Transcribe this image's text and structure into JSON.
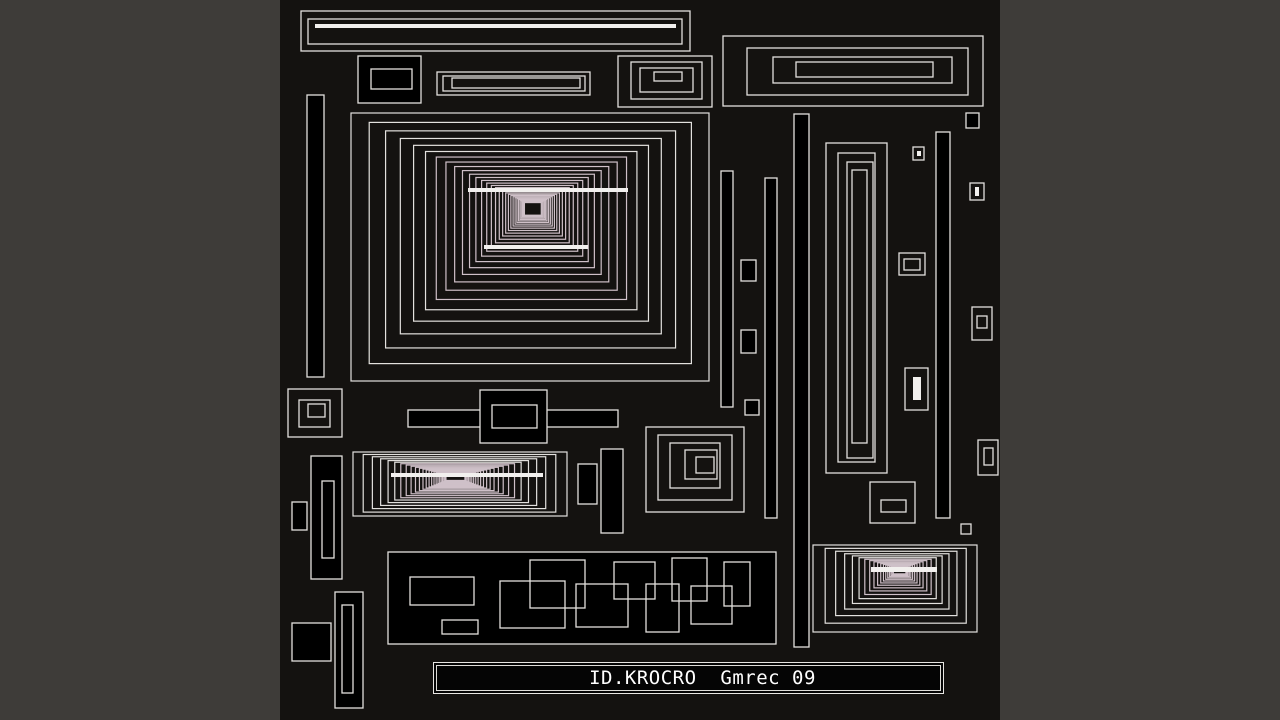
{
  "title_bar": {
    "text": "ID.KROCRO  Gmrec 09"
  },
  "colors": {
    "matte": "#3e3c39",
    "canvas_bg": "#141210",
    "shape_fill": "#000000",
    "stroke": "#e3e1de",
    "stroke_soft": "#cfc0c8",
    "accent_white": "#f2f0ee",
    "text": "#ffffff"
  },
  "artwork": {
    "shapes": [
      {
        "t": "o",
        "x": 301,
        "y": 11,
        "w": 389,
        "h": 40
      },
      {
        "t": "o",
        "x": 308,
        "y": 19,
        "w": 374,
        "h": 25
      },
      {
        "t": "w",
        "x": 315,
        "y": 24,
        "w": 361,
        "h": 4
      },
      {
        "t": "f",
        "x": 358,
        "y": 56,
        "w": 63,
        "h": 47
      },
      {
        "t": "o",
        "x": 371,
        "y": 69,
        "w": 41,
        "h": 20
      },
      {
        "t": "o",
        "x": 437,
        "y": 72,
        "w": 153,
        "h": 23
      },
      {
        "t": "o",
        "x": 443,
        "y": 76,
        "w": 142,
        "h": 15
      },
      {
        "t": "o",
        "x": 452,
        "y": 78,
        "w": 128,
        "h": 10
      },
      {
        "t": "o",
        "x": 618,
        "y": 56,
        "w": 94,
        "h": 51
      },
      {
        "t": "o",
        "x": 631,
        "y": 62,
        "w": 71,
        "h": 37
      },
      {
        "t": "o",
        "x": 640,
        "y": 68,
        "w": 53,
        "h": 24
      },
      {
        "t": "o",
        "x": 654,
        "y": 72,
        "w": 28,
        "h": 9
      },
      {
        "t": "o",
        "x": 723,
        "y": 36,
        "w": 260,
        "h": 70
      },
      {
        "t": "o",
        "x": 747,
        "y": 48,
        "w": 221,
        "h": 47
      },
      {
        "t": "o",
        "x": 773,
        "y": 57,
        "w": 179,
        "h": 26
      },
      {
        "t": "o",
        "x": 796,
        "y": 62,
        "w": 137,
        "h": 15
      },
      {
        "t": "f",
        "x": 307,
        "y": 95,
        "w": 17,
        "h": 282
      },
      {
        "t": "tunnel",
        "x": 351,
        "y": 113,
        "w": 358,
        "h": 268,
        "fx": 533,
        "fy": 207,
        "n": 30,
        "r": 0.9
      },
      {
        "t": "w",
        "x": 468,
        "y": 188,
        "w": 160,
        "h": 4
      },
      {
        "t": "w",
        "x": 484,
        "y": 245,
        "w": 104,
        "h": 4
      },
      {
        "t": "f",
        "x": 721,
        "y": 171,
        "w": 12,
        "h": 236
      },
      {
        "t": "f",
        "x": 765,
        "y": 178,
        "w": 12,
        "h": 340
      },
      {
        "t": "f",
        "x": 794,
        "y": 114,
        "w": 15,
        "h": 533
      },
      {
        "t": "f",
        "x": 936,
        "y": 132,
        "w": 14,
        "h": 386
      },
      {
        "t": "o",
        "x": 826,
        "y": 143,
        "w": 61,
        "h": 330
      },
      {
        "t": "o",
        "x": 838,
        "y": 153,
        "w": 37,
        "h": 309
      },
      {
        "t": "o",
        "x": 847,
        "y": 162,
        "w": 26,
        "h": 296
      },
      {
        "t": "o",
        "x": 852,
        "y": 170,
        "w": 15,
        "h": 273
      },
      {
        "t": "f",
        "x": 966,
        "y": 113,
        "w": 13,
        "h": 15
      },
      {
        "t": "o",
        "x": 913,
        "y": 147,
        "w": 11,
        "h": 13
      },
      {
        "t": "w",
        "x": 917,
        "y": 151,
        "w": 4,
        "h": 5
      },
      {
        "t": "o",
        "x": 970,
        "y": 183,
        "w": 14,
        "h": 17
      },
      {
        "t": "w",
        "x": 975,
        "y": 187,
        "w": 4,
        "h": 9
      },
      {
        "t": "f",
        "x": 741,
        "y": 260,
        "w": 15,
        "h": 21
      },
      {
        "t": "o",
        "x": 899,
        "y": 253,
        "w": 26,
        "h": 22
      },
      {
        "t": "o",
        "x": 904,
        "y": 259,
        "w": 16,
        "h": 11
      },
      {
        "t": "f",
        "x": 741,
        "y": 330,
        "w": 15,
        "h": 23
      },
      {
        "t": "o",
        "x": 972,
        "y": 307,
        "w": 20,
        "h": 33
      },
      {
        "t": "o",
        "x": 977,
        "y": 316,
        "w": 10,
        "h": 12
      },
      {
        "t": "o",
        "x": 905,
        "y": 368,
        "w": 23,
        "h": 42
      },
      {
        "t": "w",
        "x": 913,
        "y": 377,
        "w": 8,
        "h": 23
      },
      {
        "t": "f",
        "x": 745,
        "y": 400,
        "w": 14,
        "h": 15
      },
      {
        "t": "o",
        "x": 978,
        "y": 440,
        "w": 20,
        "h": 35
      },
      {
        "t": "o",
        "x": 984,
        "y": 448,
        "w": 9,
        "h": 17
      },
      {
        "t": "o",
        "x": 870,
        "y": 482,
        "w": 45,
        "h": 41
      },
      {
        "t": "o",
        "x": 881,
        "y": 500,
        "w": 25,
        "h": 12
      },
      {
        "t": "o",
        "x": 961,
        "y": 524,
        "w": 10,
        "h": 10
      },
      {
        "t": "o",
        "x": 288,
        "y": 389,
        "w": 54,
        "h": 48
      },
      {
        "t": "o",
        "x": 299,
        "y": 400,
        "w": 31,
        "h": 27
      },
      {
        "t": "o",
        "x": 308,
        "y": 404,
        "w": 17,
        "h": 13
      },
      {
        "t": "f",
        "x": 408,
        "y": 410,
        "w": 210,
        "h": 17
      },
      {
        "t": "f",
        "x": 480,
        "y": 390,
        "w": 67,
        "h": 53
      },
      {
        "t": "o",
        "x": 492,
        "y": 405,
        "w": 45,
        "h": 23
      },
      {
        "t": "tunnel",
        "x": 353,
        "y": 452,
        "w": 214,
        "h": 64,
        "fx": 455,
        "fy": 477,
        "n": 24,
        "r": 0.9
      },
      {
        "t": "w",
        "x": 391,
        "y": 473,
        "w": 152,
        "h": 4
      },
      {
        "t": "f",
        "x": 578,
        "y": 464,
        "w": 19,
        "h": 40
      },
      {
        "t": "f",
        "x": 601,
        "y": 449,
        "w": 22,
        "h": 84
      },
      {
        "t": "f",
        "x": 311,
        "y": 456,
        "w": 31,
        "h": 123
      },
      {
        "t": "o",
        "x": 322,
        "y": 481,
        "w": 12,
        "h": 77
      },
      {
        "t": "f",
        "x": 292,
        "y": 502,
        "w": 15,
        "h": 28
      },
      {
        "t": "o",
        "x": 646,
        "y": 427,
        "w": 98,
        "h": 85
      },
      {
        "t": "o",
        "x": 658,
        "y": 435,
        "w": 74,
        "h": 65
      },
      {
        "t": "o",
        "x": 670,
        "y": 443,
        "w": 50,
        "h": 45
      },
      {
        "t": "o",
        "x": 685,
        "y": 450,
        "w": 32,
        "h": 29
      },
      {
        "t": "o",
        "x": 696,
        "y": 457,
        "w": 18,
        "h": 16
      },
      {
        "t": "f",
        "x": 292,
        "y": 623,
        "w": 39,
        "h": 38
      },
      {
        "t": "f",
        "x": 335,
        "y": 592,
        "w": 28,
        "h": 116
      },
      {
        "t": "o",
        "x": 342,
        "y": 605,
        "w": 11,
        "h": 88
      },
      {
        "t": "f",
        "x": 388,
        "y": 552,
        "w": 388,
        "h": 92
      },
      {
        "t": "o",
        "x": 410,
        "y": 577,
        "w": 64,
        "h": 28
      },
      {
        "t": "o",
        "x": 442,
        "y": 620,
        "w": 36,
        "h": 14
      },
      {
        "t": "o",
        "x": 500,
        "y": 581,
        "w": 65,
        "h": 47
      },
      {
        "t": "o",
        "x": 530,
        "y": 560,
        "w": 55,
        "h": 48
      },
      {
        "t": "o",
        "x": 576,
        "y": 584,
        "w": 52,
        "h": 43
      },
      {
        "t": "o",
        "x": 614,
        "y": 562,
        "w": 41,
        "h": 37
      },
      {
        "t": "o",
        "x": 646,
        "y": 584,
        "w": 33,
        "h": 48
      },
      {
        "t": "o",
        "x": 672,
        "y": 558,
        "w": 35,
        "h": 43
      },
      {
        "t": "o",
        "x": 691,
        "y": 586,
        "w": 41,
        "h": 38
      },
      {
        "t": "o",
        "x": 724,
        "y": 562,
        "w": 26,
        "h": 44
      },
      {
        "t": "tunnel",
        "x": 813,
        "y": 545,
        "w": 164,
        "h": 87,
        "fx": 900,
        "fy": 569,
        "n": 18,
        "r": 0.86
      },
      {
        "t": "w",
        "x": 871,
        "y": 567,
        "w": 66,
        "h": 5
      }
    ]
  }
}
